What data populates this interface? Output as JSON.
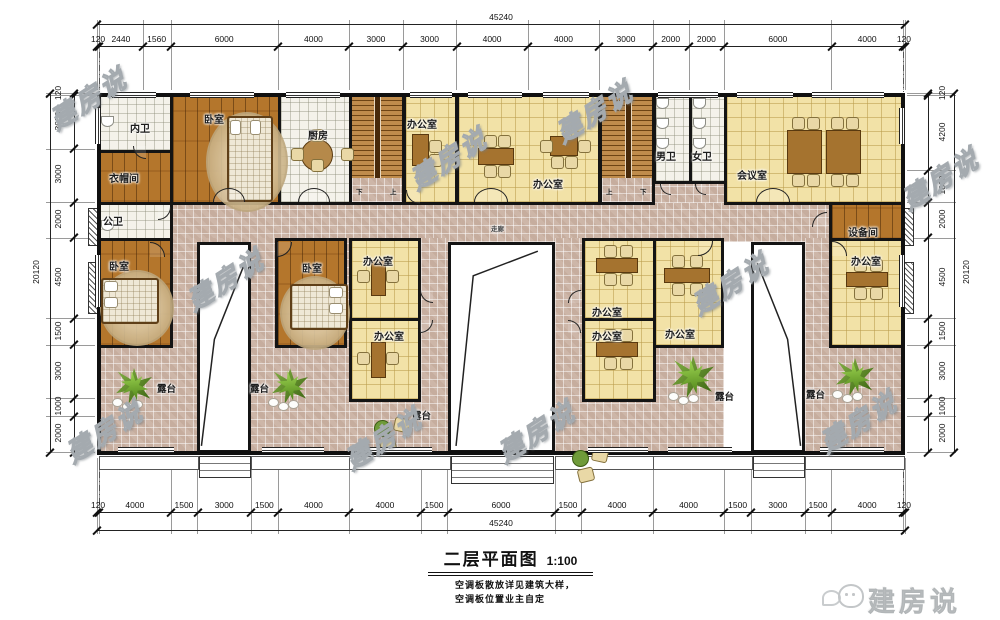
{
  "watermark": {
    "text": "建房说"
  },
  "logo": {
    "brand": "建房说"
  },
  "title": {
    "name": "二层平面图",
    "scale": "1:100"
  },
  "notes": [
    "空调板散放详见建筑大样，",
    "空调板位置业主自定"
  ],
  "stairs": {
    "up": "上",
    "down": "下"
  },
  "rooms": {
    "inner_bath": {
      "label": "内卫"
    },
    "cloakroom": {
      "label": "衣帽间"
    },
    "bedroom_top": {
      "label": "卧室"
    },
    "kitchen": {
      "label": "厨房"
    },
    "public_bath": {
      "label": "公卫"
    },
    "office": {
      "label": "办公室"
    },
    "mens_wc": {
      "label": "男卫"
    },
    "womens_wc": {
      "label": "女卫"
    },
    "meeting": {
      "label": "会议室"
    },
    "equipment": {
      "label": "设备间"
    },
    "corridor": {
      "label": "走廊"
    },
    "bedroom_a": {
      "label": "卧室"
    },
    "bedroom_b": {
      "label": "卧室"
    },
    "terrace": {
      "label": "露台"
    }
  },
  "dims": {
    "top": {
      "total": "45240",
      "segments": [
        120,
        2440,
        1560,
        6000,
        4000,
        3000,
        3000,
        4000,
        4000,
        3000,
        2000,
        2000,
        6000,
        4000,
        120
      ]
    },
    "bottom": {
      "total": "45240",
      "segments": [
        120,
        4000,
        1500,
        3000,
        1500,
        4000,
        4000,
        1500,
        6000,
        1500,
        4000,
        4000,
        1500,
        3000,
        1500,
        4000,
        120
      ]
    },
    "left": {
      "total": "20120",
      "segments": [
        120,
        3000,
        3000,
        2000,
        4500,
        1500,
        3000,
        1000,
        2000
      ]
    },
    "right": {
      "total": "20120",
      "segments": [
        120,
        4200,
        1800,
        2000,
        4500,
        1500,
        3000,
        1000,
        2000
      ]
    }
  }
}
